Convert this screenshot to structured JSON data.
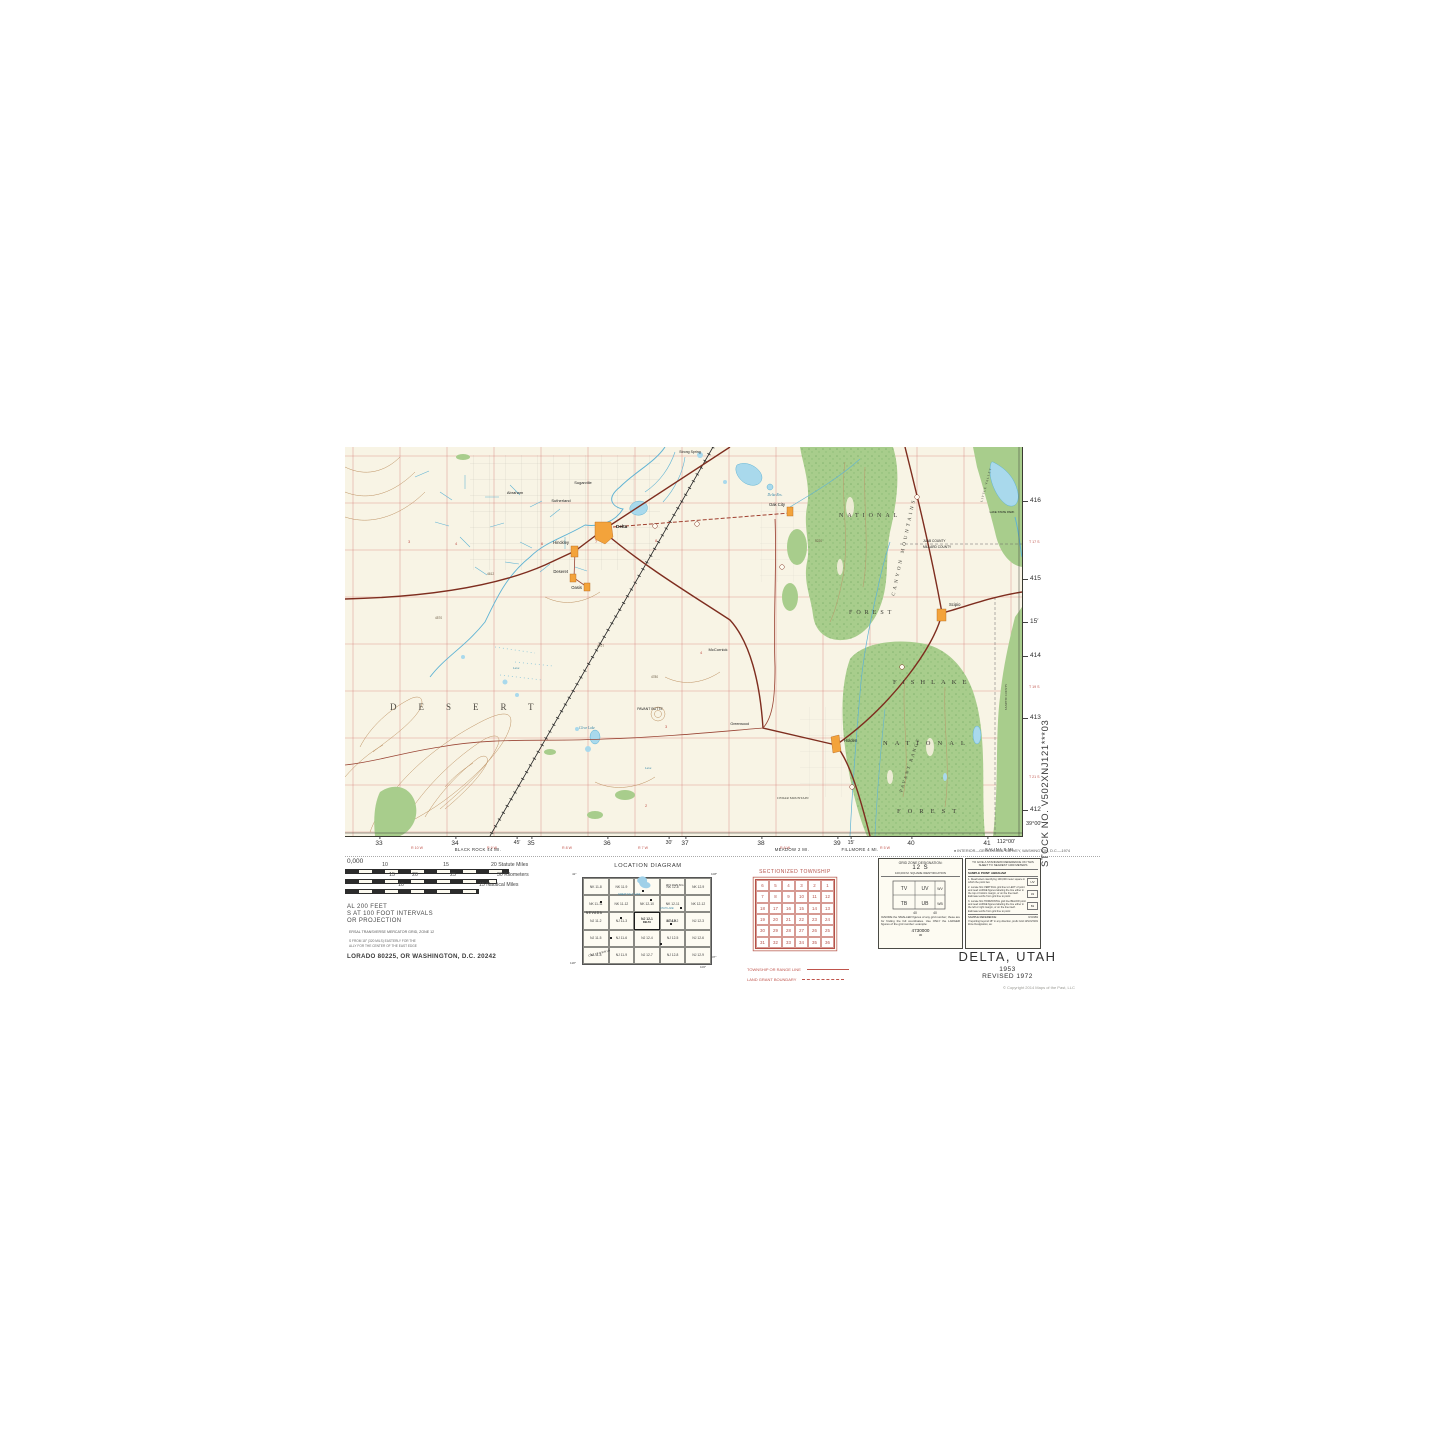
{
  "colors": {
    "paper": "#f8f4e5",
    "forest": "#a8cd8c",
    "forest_dark": "#6ca45d",
    "water_fill": "#a9d9ec",
    "water_line": "#5fb3d4",
    "contour": "#bc8f5f",
    "road": "#7e2d1f",
    "grid_red": "#d4827a",
    "town": "#f3a33b",
    "legend_red": "#c0544c"
  },
  "map": {
    "labels": {
      "desert": "DESERT",
      "fishlake": "FISHLAKE",
      "national_lower": "NATIONAL",
      "forest_lower": "FOREST",
      "national_upper": "NATIONAL",
      "forest_upper": "FOREST",
      "canyon_mountains": "CANYON MOUNTAINS",
      "pavant_range": "PAVANT RANGE",
      "little_valley": "LITTLE VALLEY",
      "cedar_mountain": "CEDAR MOUNTAIN",
      "juab_county": "JUAB COUNTY",
      "millard_county": "MILLARD COUNTY",
      "sanpete_county": "SANPETE COUNTY",
      "delta": "Delta",
      "hinckley": "Hinckley",
      "deseret": "Deseret",
      "oasis": "Oasis",
      "oak_city": "Oak City",
      "scipio": "Scipio",
      "holden": "Holden",
      "mccornick": "McCornick",
      "greenwood": "Greenwood",
      "abraham": "Abraham",
      "sutherland": "Sutherland",
      "sugarville": "Sugarville",
      "strong_spring": "Strong Spring",
      "delta_res": "Delta Res.",
      "clear_lake": "Clear Lake",
      "pavant_butte": "PAVANT BUTTE",
      "lake_state_park": "LAKE STATE PARK",
      "lava1": "Lava",
      "lava2": "Lava"
    },
    "scatter": {
      "red_numbers": [
        "3",
        "4",
        "6",
        "7",
        "8",
        "4",
        "3",
        "2"
      ],
      "elevations": [
        "4570",
        "4612",
        "4707",
        "4780",
        "5220"
      ]
    },
    "margin": {
      "right_ticks": [
        "416",
        "415",
        "15′",
        "414",
        "413",
        "412"
      ],
      "right_townships": [
        "T 17 S",
        "T 19 S",
        "T 21 S"
      ],
      "corner_lat": "39°00′",
      "corner_lon": "112°00′",
      "bottom_ticks": [
        "33",
        "34",
        "45′",
        "35",
        "36",
        "30′",
        "37",
        "38",
        "39",
        "15′",
        "40",
        "41"
      ],
      "bottom_ranges": [
        "R 10 W",
        "R 9 W",
        "R 8 W",
        "R 7 W",
        "R 6 W",
        "R 5 W"
      ],
      "destinations": [
        "BLACK ROCK 44 MI.",
        "MEADOW 2 MI.",
        "FILLMORE 4 MI.",
        "SALINA 8 MI."
      ],
      "credit": "● INTERIOR—GEOLOGICAL SURVEY, WASHINGTON, D.C.—1974"
    }
  },
  "legend": {
    "scale_fragment": "0,000",
    "bar1_ticks": [
      "10",
      "15"
    ],
    "bar1_end": "20 Statute Miles",
    "bar2_ticks": [
      "15",
      "20",
      "25"
    ],
    "bar2_end": "30 Kilometers",
    "bar3_ticks": [
      "10"
    ],
    "bar3_end": "15 Nautical Miles",
    "contour_lines": [
      "AL 200 FEET",
      "S AT 100 FOOT INTERVALS",
      "OR PROJECTION"
    ],
    "utm_line": "ERSAL TRANSVERSE MERCATOR GRID, ZONE 12",
    "decl_lines": [
      "S FROM 18° (320 MILS) EASTERLY FOR THE",
      "ALLY FOR THE CENTER OF THE EAST EDGE"
    ],
    "address": "LORADO 80225, OR WASHINGTON, D.C. 20242"
  },
  "location_diagram": {
    "title": "LOCATION DIAGRAM",
    "cells": [
      "NK 11-8",
      "NK 11-9",
      "",
      "NK 12-8",
      "NK 12-9",
      "NK 11-11",
      "NK 11-12",
      "NK 12-10",
      "NK 12-11",
      "NK 12-12",
      "NJ 11-2",
      "NJ 11-3",
      "NJ 12-1",
      "NJ 12-2",
      "NJ 12-3",
      "NJ 11-5",
      "NJ 11-6",
      "NJ 12-4",
      "NJ 12-5",
      "NJ 12-6",
      "NJ 11-8",
      "NJ 11-9",
      "NJ 12-7",
      "NJ 12-8",
      "NJ 12-9"
    ],
    "highlight_index": 12,
    "highlight_label": "DELTA",
    "states": {
      "nevada": "NEVADA",
      "utah": "UTAH",
      "wyoming": "WYOMING",
      "california": "CALIFORNIA"
    },
    "water_labels": {
      "gsl": "GREAT SALT LAKE",
      "utah_lake": "UTAH LAKE"
    },
    "corners": {
      "tl": "42°",
      "tr": "108°",
      "bl": "118°",
      "br": "106°",
      "br2": "37°"
    }
  },
  "sectionized_township": {
    "title": "SECTIONIZED TOWNSHIP",
    "rows": [
      [
        "6",
        "5",
        "4",
        "3",
        "2",
        "1"
      ],
      [
        "7",
        "8",
        "9",
        "10",
        "11",
        "12"
      ],
      [
        "18",
        "17",
        "16",
        "15",
        "14",
        "13"
      ],
      [
        "19",
        "20",
        "21",
        "22",
        "23",
        "24"
      ],
      [
        "30",
        "29",
        "28",
        "27",
        "26",
        "25"
      ],
      [
        "31",
        "32",
        "33",
        "34",
        "35",
        "36"
      ]
    ],
    "legend1": "TOWNSHIP OR RANGE LINE",
    "legend2": "LAND GRANT BOUNDARY"
  },
  "grid_zone": {
    "title": "GRID ZONE DESIGNATION:",
    "zone": "12 S",
    "subtitle": "100,000 M. SQUARE IDENTIFICATION",
    "squares": [
      "TV",
      "UV",
      "WV",
      "TB",
      "UB",
      "WB"
    ],
    "axis_numbers": [
      "40",
      "40"
    ],
    "note": "IGNORE the SMALLER figures of any grid number; these are for finding the full coordinates. Use ONLY the LARGER figures of the grid number: example:",
    "example": "4730000",
    "example_sub": "30"
  },
  "reference_box": {
    "title": "TO GIVE A STANDARD REFERENCE ON THIS SHEET TO NEAREST 1000 METERS",
    "sample_point": "SAMPLE POINT:  ABRAHAM",
    "steps": [
      "1. Read letters identifying 100,000 meter square in which the point lies:",
      "2. Locate first VERTICAL grid line to LEFT of point and read LARGE figures labeling the line either in the top or bottom margin, or on the line itself. Estimate tenths from grid line to point:",
      "3. Locate first HORIZONTAL grid line BELOW point and read LARGE figures labeling the line either in the left or right margin, or on the line itself. Estimate tenths from grid line to point:"
    ],
    "step_values": [
      "UV",
      "31",
      "81"
    ],
    "sample_reference": "SAMPLE REFERENCE:",
    "sample_value": "UV3181",
    "beyond": "If reporting beyond 18° in any direction, prefix Grid Zone Designation, as:",
    "beyond_value": "12SUV3181"
  },
  "title_block": {
    "name": "DELTA, UTAH",
    "year": "1953",
    "revised": "REVISED 1972",
    "copyright": "© Copyright 2014 Maps of the Past, LLC"
  },
  "stock_number": "STOCK NO. V502XNJ121***03"
}
